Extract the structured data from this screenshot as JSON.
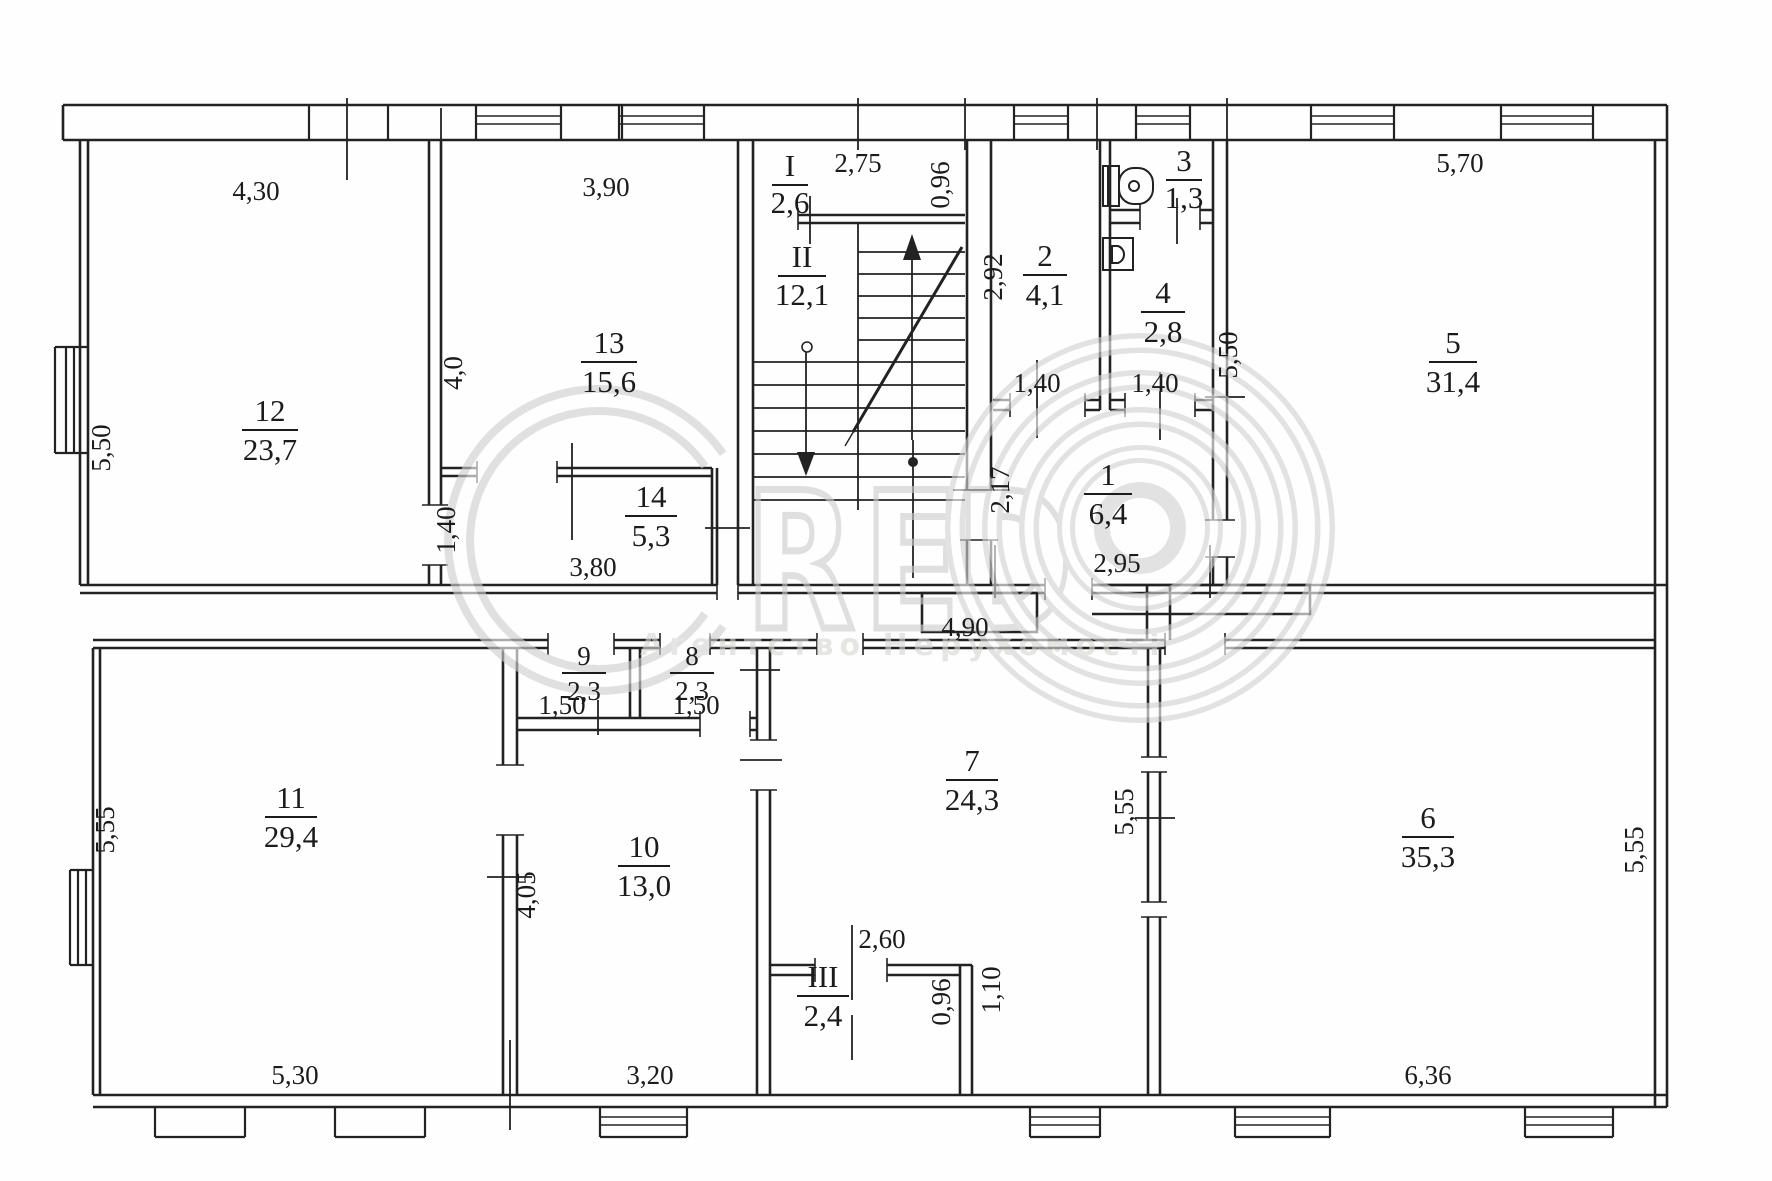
{
  "watermark": {
    "letter_c": "C",
    "letter_r": "R",
    "letter_e": "E",
    "letter_d": "D",
    "subtitle": "Агентство Нерухомості"
  },
  "rooms": {
    "r1": {
      "number": "1",
      "area": "6,4"
    },
    "r2": {
      "number": "2",
      "area": "4,1"
    },
    "r3": {
      "number": "3",
      "area": "1,3"
    },
    "r4": {
      "number": "4",
      "area": "2,8"
    },
    "r5": {
      "number": "5",
      "area": "31,4"
    },
    "r6": {
      "number": "6",
      "area": "35,3"
    },
    "r7": {
      "number": "7",
      "area": "24,3"
    },
    "r8": {
      "number": "8",
      "area": "2,3"
    },
    "r9": {
      "number": "9",
      "area": "2,3"
    },
    "r10": {
      "number": "10",
      "area": "13,0"
    },
    "r11": {
      "number": "11",
      "area": "29,4"
    },
    "r12": {
      "number": "12",
      "area": "23,7"
    },
    "r13": {
      "number": "13",
      "area": "15,6"
    },
    "r14": {
      "number": "14",
      "area": "5,3"
    },
    "rI": {
      "number": "I",
      "area": "2,6"
    },
    "rII": {
      "number": "II",
      "area": "12,1"
    },
    "rIII": {
      "number": "III",
      "area": "2,4"
    }
  },
  "dimensions": {
    "room12_width": "4,30",
    "room12_height": "5,50",
    "room13_width": "3,90",
    "room13_height": "4,0",
    "room14_width": "3,80",
    "room14_height": "1,40",
    "stairs_width": "2,75",
    "vestibule_depth": "0,96",
    "room2_height": "2,92",
    "room2_door_width": "1,40",
    "room4_door_width": "1,40",
    "room5_width": "5,70",
    "room5_height": "5,50",
    "room1_width": "2,95",
    "room1_height": "2,17",
    "entry_width": "4,90",
    "room9_width": "1,50",
    "room8_width": "1,50",
    "room11_width": "5,30",
    "room11_height": "5,55",
    "room10_width": "3,20",
    "room10_height": "4,05",
    "roomIII_width": "2,60",
    "roomIII_height": "0,96",
    "roomIII_offset": "1,10",
    "room7_height": "5,55",
    "room6_height": "5,55",
    "room6_width": "6,36"
  }
}
